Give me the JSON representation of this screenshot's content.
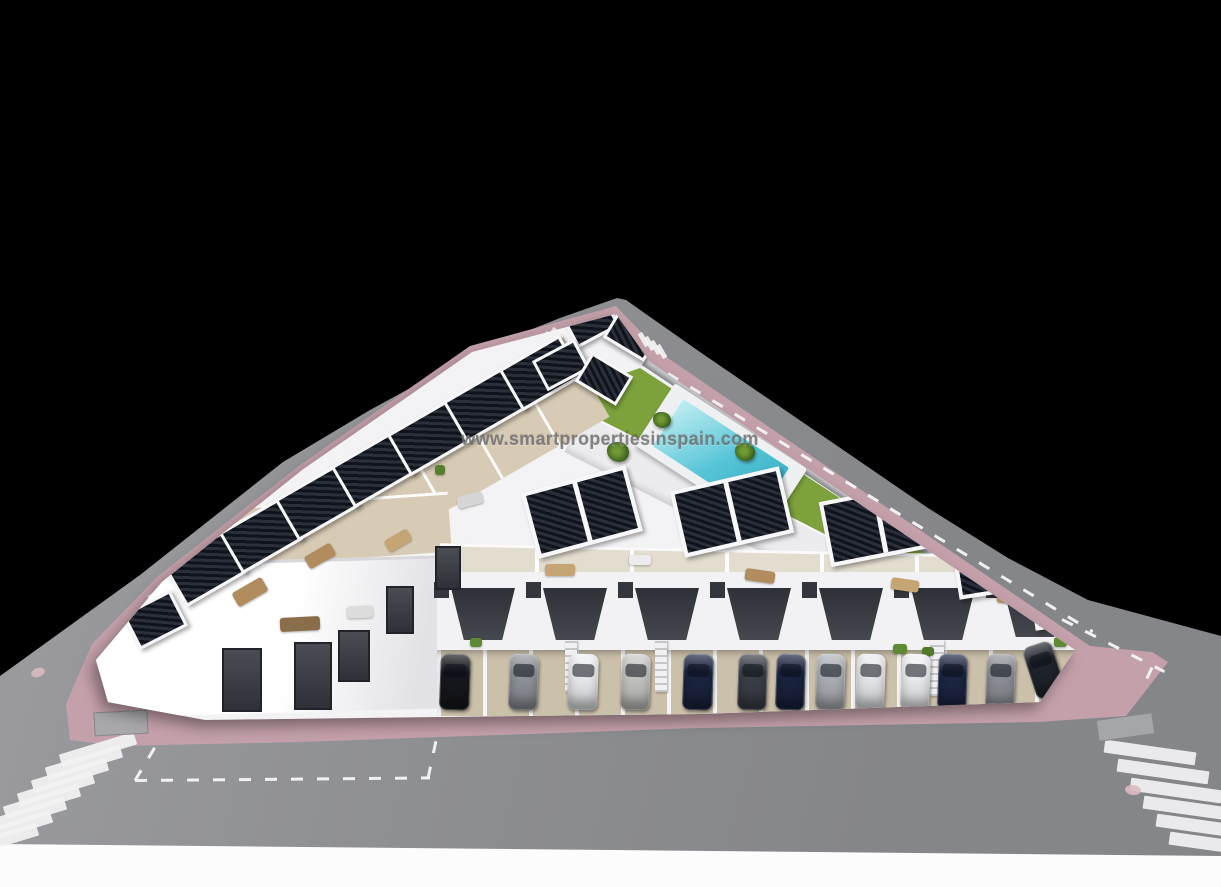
{
  "scene": {
    "description": "Aerial 3D render of a triangular white residential development with rooftop solar pergolas, roof terraces, communal lawn with pool, street parking with cars, pink sidewalks and zebra crosswalks, on a black background",
    "watermark": "www.smartpropertiesinspain.com"
  },
  "palette": {
    "background": "#000000",
    "road": "#8f9094",
    "sidewalk_pink": "#c4a0aa",
    "building_white": "#f3f3f5",
    "facade_dark": "#3f424a",
    "terrace_beige": "#d8cbb5",
    "driveway_beige": "#cbc0aa",
    "lawn_green": "#7da23c",
    "pool_teal": "#55c4d6",
    "pool_deck": "#eef0f2",
    "solar_dark": "#10141c",
    "marking_white": "#f2f2f3"
  },
  "groups": [
    {
      "mount": "#g-panels",
      "name": "solar-pergola",
      "class": "panel",
      "items": [
        [
          202,
          566,
          64,
          42,
          -30
        ],
        [
          258,
          533,
          64,
          42,
          -30
        ],
        [
          314,
          500,
          64,
          42,
          -30
        ],
        [
          370,
          467,
          64,
          42,
          -30
        ],
        [
          426,
          435,
          64,
          42,
          -30
        ],
        [
          482,
          402,
          64,
          42,
          -30
        ],
        [
          538,
          370,
          64,
          42,
          -30
        ],
        [
          152,
          617,
          48,
          34,
          -27
        ],
        [
          588,
          319,
          42,
          28,
          -28
        ],
        [
          629,
          332,
          42,
          28,
          31
        ],
        [
          558,
          362,
          42,
          28,
          -28
        ],
        [
          601,
          376,
          42,
          28,
          31
        ]
      ]
    },
    {
      "mount": "#g-pergolas",
      "name": "solar-pergola-large",
      "class": "panel panel-lg",
      "items": [
        [
          578,
          508,
          100,
          60,
          -15
        ],
        [
          728,
          508,
          104,
          60,
          -13
        ],
        [
          876,
          520,
          104,
          58,
          -11
        ],
        [
          1002,
          556,
          96,
          56,
          -9
        ],
        [
          1064,
          598,
          64,
          40,
          -8
        ]
      ]
    },
    {
      "mount": "#g-canopies",
      "name": "porch-canopy",
      "class": "canopy",
      "items": [
        [
          483,
          614,
          64,
          52,
          0
        ],
        [
          575,
          614,
          64,
          52,
          0
        ],
        [
          667,
          614,
          64,
          52,
          0
        ],
        [
          759,
          614,
          64,
          52,
          0
        ],
        [
          851,
          614,
          64,
          52,
          0
        ],
        [
          943,
          614,
          64,
          52,
          0
        ],
        [
          1035,
          612,
          64,
          50,
          0
        ]
      ]
    },
    {
      "mount": "#g-slits",
      "name": "window-slit",
      "class": "slit",
      "items": [
        [
          441,
          590,
          15,
          16,
          0
        ],
        [
          533,
          590,
          15,
          16,
          0
        ],
        [
          625,
          590,
          15,
          16,
          0
        ],
        [
          717,
          590,
          15,
          16,
          0
        ],
        [
          809,
          590,
          15,
          16,
          0
        ],
        [
          901,
          590,
          15,
          16,
          0
        ],
        [
          993,
          590,
          15,
          16,
          0
        ],
        [
          1066,
          590,
          14,
          16,
          0
        ]
      ]
    },
    {
      "mount": "#g-windows",
      "name": "facade-window",
      "class": "winslot",
      "items": [
        [
          240,
          678,
          36,
          60,
          0
        ],
        [
          311,
          674,
          34,
          64,
          0
        ],
        [
          352,
          654,
          28,
          48,
          0
        ],
        [
          398,
          608,
          24,
          44,
          0
        ],
        [
          446,
          566,
          22,
          40,
          0
        ]
      ]
    },
    {
      "mount": "#g-stairs",
      "name": "exterior-stairs",
      "class": "stairs",
      "items": [
        [
          571,
          666,
          12,
          52,
          0
        ],
        [
          661,
          666,
          12,
          52,
          0
        ],
        [
          937,
          668,
          14,
          56,
          0
        ]
      ]
    },
    {
      "mount": "#g-cars",
      "name": "parked-car",
      "class": "car",
      "items": [
        [
          455,
          682,
          30,
          56,
          2,
          "#17181d"
        ],
        [
          523,
          682,
          29,
          56,
          2,
          "#90949b"
        ],
        [
          583,
          682,
          30,
          56,
          2,
          "#eceef0"
        ],
        [
          635,
          682,
          29,
          56,
          2,
          "#c7c8c5"
        ],
        [
          698,
          682,
          30,
          56,
          2,
          "#1b2440"
        ],
        [
          752,
          682,
          29,
          56,
          2,
          "#3b3f47"
        ],
        [
          790,
          682,
          29,
          56,
          2,
          "#1a2340"
        ],
        [
          830,
          682,
          29,
          56,
          2,
          "#aeb2b8"
        ],
        [
          870,
          682,
          29,
          56,
          2,
          "#e9ebee"
        ],
        [
          915,
          682,
          29,
          56,
          2,
          "#f0f1f3"
        ],
        [
          952,
          682,
          29,
          56,
          2,
          "#1c2543"
        ],
        [
          1000,
          682,
          29,
          56,
          2,
          "#8e9298"
        ],
        [
          1044,
          670,
          30,
          54,
          -18,
          "#20242c"
        ]
      ]
    },
    {
      "mount": "#g-palms",
      "name": "palm-tree",
      "class": "palm",
      "items": [
        [
          618,
          452,
          22,
          20,
          0
        ],
        [
          700,
          498,
          24,
          22,
          0
        ],
        [
          745,
          452,
          20,
          18,
          0
        ],
        [
          662,
          420,
          18,
          16,
          0
        ]
      ]
    },
    {
      "mount": "#g-props",
      "name": "terrace-furniture",
      "class": "prop",
      "items": [
        [
          250,
          592,
          34,
          16,
          -30,
          "#b08c5e"
        ],
        [
          320,
          556,
          30,
          14,
          -30,
          "#b08c5e"
        ],
        [
          398,
          540,
          26,
          13,
          -30,
          "#c5a574"
        ],
        [
          300,
          624,
          40,
          14,
          -3,
          "#8a6d49"
        ],
        [
          360,
          612,
          26,
          12,
          -3,
          "#dcdcdc"
        ],
        [
          560,
          570,
          30,
          12,
          0,
          "#c5a574"
        ],
        [
          760,
          576,
          30,
          12,
          8,
          "#b08c5e"
        ],
        [
          905,
          585,
          28,
          12,
          8,
          "#c5a574"
        ],
        [
          1010,
          598,
          26,
          11,
          8,
          "#b08c5e"
        ],
        [
          470,
          500,
          26,
          12,
          -15,
          "#d6d6d6"
        ],
        [
          640,
          560,
          22,
          10,
          0,
          "#ececec"
        ],
        [
          900,
          649,
          14,
          10,
          0,
          "#5d8a33"
        ],
        [
          928,
          651,
          12,
          9,
          0,
          "#4f7a2b"
        ],
        [
          1060,
          642,
          13,
          10,
          0,
          "#5d8a33"
        ],
        [
          476,
          642,
          12,
          9,
          0,
          "#5d8a33"
        ],
        [
          440,
          470,
          10,
          10,
          0,
          "#567f2e"
        ]
      ]
    },
    {
      "mount": "#g-zebra",
      "name": "crosswalk-stripe",
      "class": "stripe",
      "items": [
        [
          98,
          749,
          78,
          13,
          -17
        ],
        [
          84,
          762,
          78,
          13,
          -17
        ],
        [
          70,
          775,
          78,
          13,
          -17
        ],
        [
          56,
          788,
          78,
          13,
          -17
        ],
        [
          42,
          801,
          78,
          13,
          -17
        ],
        [
          28,
          814,
          78,
          13,
          -17
        ],
        [
          14,
          827,
          78,
          13,
          -17
        ],
        [
          0,
          840,
          78,
          13,
          -17
        ],
        [
          1150,
          752,
          92,
          13,
          8
        ],
        [
          1163,
          771,
          92,
          13,
          8
        ],
        [
          1176,
          790,
          92,
          13,
          8
        ],
        [
          1189,
          808,
          92,
          13,
          8
        ],
        [
          1202,
          826,
          92,
          13,
          8
        ],
        [
          1215,
          844,
          92,
          13,
          8
        ]
      ]
    },
    {
      "mount": "#g-xwalk",
      "name": "apex-crosswalk-stripe",
      "class": "stripe",
      "items": [
        [
          523,
          352,
          5,
          16,
          30
        ],
        [
          530,
          348,
          5,
          16,
          30
        ],
        [
          537,
          343,
          5,
          16,
          30
        ],
        [
          544,
          339,
          5,
          16,
          30
        ],
        [
          551,
          335,
          5,
          16,
          30
        ],
        [
          643,
          339,
          5,
          15,
          -30
        ],
        [
          649,
          343,
          5,
          15,
          -30
        ],
        [
          655,
          347,
          5,
          15,
          -30
        ],
        [
          661,
          351,
          5,
          15,
          -30
        ]
      ]
    },
    {
      "mount": "#g-dashes",
      "name": "lane-dash-line",
      "class": "dashline",
      "origin": "corner",
      "items": [
        [
          148,
          596,
          487,
          3,
          -32
        ],
        [
          668,
          372,
          497,
          3,
          31.3
        ],
        [
          1062,
          618,
          115,
          3,
          27
        ],
        [
          1152,
          666,
          20,
          3,
          115
        ],
        [
          135,
          779,
          295,
          3,
          -0.5
        ],
        [
          135,
          779,
          46,
          3,
          -59
        ],
        [
          428,
          777,
          40,
          3,
          -78
        ]
      ]
    },
    {
      "mount": "#g-marks",
      "name": "manhole-cover",
      "class": "manhole",
      "items": [
        [
          38,
          672,
          14,
          9,
          -20
        ],
        [
          1133,
          790,
          16,
          10,
          8
        ]
      ]
    },
    {
      "mount": "#g-marks",
      "name": "utility-patch",
      "class": "patch",
      "items": [
        [
          120,
          722,
          52,
          22,
          -3
        ],
        [
          1124,
          726,
          55,
          20,
          -8
        ]
      ]
    }
  ]
}
